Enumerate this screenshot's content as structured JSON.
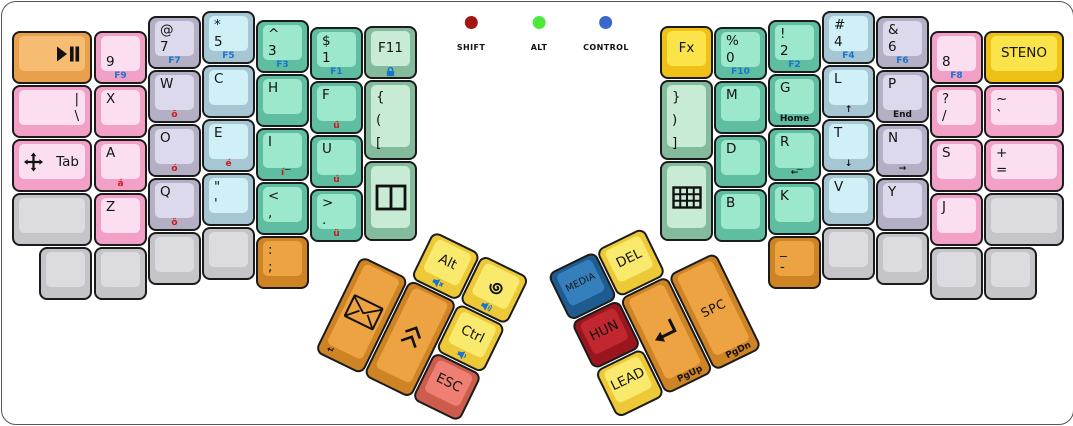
{
  "indicators": [
    {
      "name": "indicator-shift",
      "label": "SHIFT",
      "color": "#A21510",
      "x": 469
    },
    {
      "name": "indicator-alt",
      "label": "ALT",
      "color": "#4CE93B",
      "x": 537
    },
    {
      "name": "indicator-control",
      "label": "CONTROL",
      "color": "#3A67CE",
      "x": 604
    }
  ],
  "palette": {
    "pink": {
      "side": "#F2A0C5",
      "top": "#FBDFF1"
    },
    "lavender": {
      "side": "#B5AFC6",
      "top": "#DDD9EC"
    },
    "cyan": {
      "side": "#A6C6D4",
      "top": "#D0F0F8"
    },
    "green": {
      "side": "#5FBEA1",
      "top": "#9BE8CD"
    },
    "palegreen": {
      "side": "#84BB9D",
      "top": "#C8EBD6"
    },
    "gray": {
      "side": "#C4C4C9",
      "top": "#DCDCE0"
    },
    "orange": {
      "side": "#CE8424",
      "top": "#EDA341"
    },
    "orangelight": {
      "side": "#E9A04D",
      "top": "#F5BC72"
    },
    "yellow": {
      "side": "#EDC937",
      "top": "#F9E96C"
    },
    "yellowbright": {
      "side": "#EFC117",
      "top": "#FBE34A"
    },
    "red": {
      "side": "#CC5D4D",
      "top": "#EE7F72"
    },
    "darkred": {
      "side": "#99161F",
      "top": "#C2262F"
    },
    "blue": {
      "side": "#1E5C90",
      "top": "#3580BC"
    }
  },
  "legend_colors": {
    "blue": "#1874CE",
    "red": "#CE1A1A",
    "black": "#141414"
  },
  "keys": [
    {
      "name": "key-play-pause",
      "family": "orangelight",
      "x": 10,
      "y": 29,
      "w": 80,
      "icon": "play-pause",
      "iconAlign": "right"
    },
    {
      "name": "key-pipe-backslash",
      "family": "pink",
      "x": 10,
      "y": 83,
      "w": 80,
      "align": "right",
      "lines": [
        "|",
        "\\"
      ]
    },
    {
      "name": "key-tab",
      "family": "pink",
      "x": 10,
      "y": 137,
      "w": 80,
      "align": "right",
      "v": "c",
      "lines": [
        "Tab"
      ],
      "icon": "move",
      "iconAlign": "left"
    },
    {
      "name": "key-blank",
      "family": "gray",
      "x": 10,
      "y": 191,
      "w": 80
    },
    {
      "name": "key-blank",
      "family": "gray",
      "x": 37,
      "y": 245
    },
    {
      "name": "key-9",
      "family": "pink",
      "x": 92,
      "y": 29,
      "lines": [
        "",
        "9"
      ],
      "front": {
        "t": "F9",
        "c": "blue"
      }
    },
    {
      "name": "key-x",
      "family": "pink",
      "x": 92,
      "y": 83,
      "lines": [
        "X"
      ]
    },
    {
      "name": "key-a",
      "family": "pink",
      "x": 92,
      "y": 137,
      "lines": [
        "A"
      ],
      "front": {
        "t": "á",
        "c": "red"
      }
    },
    {
      "name": "key-z",
      "family": "pink",
      "x": 92,
      "y": 191,
      "lines": [
        "Z"
      ]
    },
    {
      "name": "key-blank",
      "family": "gray",
      "x": 92,
      "y": 245
    },
    {
      "name": "key-at-7",
      "family": "lavender",
      "x": 146,
      "y": 14,
      "lines": [
        "@",
        "7"
      ],
      "front": {
        "t": "F7",
        "c": "blue"
      }
    },
    {
      "name": "key-w",
      "family": "lavender",
      "x": 146,
      "y": 68,
      "lines": [
        "W"
      ],
      "front": {
        "t": "õ",
        "c": "red"
      }
    },
    {
      "name": "key-o",
      "family": "lavender",
      "x": 146,
      "y": 122,
      "lines": [
        "O"
      ],
      "front": {
        "t": "ó",
        "c": "red"
      }
    },
    {
      "name": "key-q",
      "family": "lavender",
      "x": 146,
      "y": 176,
      "lines": [
        "Q"
      ],
      "front": {
        "t": "ö",
        "c": "red"
      }
    },
    {
      "name": "key-blank",
      "family": "gray",
      "x": 146,
      "y": 230
    },
    {
      "name": "key-star-5",
      "family": "cyan",
      "x": 200,
      "y": 9,
      "lines": [
        "*",
        "5"
      ],
      "front": {
        "t": "F5",
        "c": "blue"
      }
    },
    {
      "name": "key-c",
      "family": "cyan",
      "x": 200,
      "y": 63,
      "lines": [
        "C"
      ]
    },
    {
      "name": "key-e",
      "family": "cyan",
      "x": 200,
      "y": 117,
      "lines": [
        "E"
      ],
      "front": {
        "t": "é",
        "c": "red"
      }
    },
    {
      "name": "key-quote",
      "family": "cyan",
      "x": 200,
      "y": 171,
      "lines": [
        "\"",
        "'"
      ]
    },
    {
      "name": "key-blank",
      "family": "gray",
      "x": 200,
      "y": 225
    },
    {
      "name": "key-caret-3",
      "family": "green",
      "x": 254,
      "y": 18,
      "lines": [
        "^",
        "3"
      ],
      "front": {
        "t": "F3",
        "c": "blue"
      }
    },
    {
      "name": "key-h",
      "family": "green",
      "x": 254,
      "y": 72,
      "lines": [
        "H"
      ]
    },
    {
      "name": "key-i",
      "family": "green",
      "x": 254,
      "y": 126,
      "lines": [
        "I"
      ],
      "sub": "_",
      "front": {
        "t": "í",
        "c": "red"
      }
    },
    {
      "name": "key-less-comma",
      "family": "green",
      "x": 254,
      "y": 180,
      "lines": [
        "<",
        ","
      ]
    },
    {
      "name": "key-colon-semicolon",
      "family": "orange",
      "x": 254,
      "y": 234,
      "lines": [
        ":",
        ";"
      ]
    },
    {
      "name": "key-dollar-1",
      "family": "green",
      "x": 308,
      "y": 25,
      "lines": [
        "$",
        "1"
      ],
      "front": {
        "t": "F1",
        "c": "blue"
      }
    },
    {
      "name": "key-f",
      "family": "green",
      "x": 308,
      "y": 79,
      "lines": [
        "F"
      ],
      "front": {
        "t": "ű",
        "c": "red"
      }
    },
    {
      "name": "key-u",
      "family": "green",
      "x": 308,
      "y": 133,
      "lines": [
        "U"
      ],
      "front": {
        "t": "ú",
        "c": "red"
      }
    },
    {
      "name": "key-greater-period",
      "family": "green",
      "x": 308,
      "y": 187,
      "lines": [
        ">",
        "."
      ],
      "front": {
        "t": "ü",
        "c": "red"
      }
    },
    {
      "name": "key-f11",
      "family": "palegreen",
      "x": 362,
      "y": 24,
      "center": true,
      "lines": [
        "F11"
      ],
      "front": {
        "icon": "lock"
      }
    },
    {
      "name": "key-open-brackets",
      "family": "palegreen",
      "x": 362,
      "y": 78,
      "h": 80,
      "lines": [
        "{",
        "(",
        "["
      ]
    },
    {
      "name": "key-window-split",
      "family": "palegreen",
      "x": 362,
      "y": 159,
      "h": 80,
      "center": true,
      "icon": "window-split"
    },
    {
      "name": "key-fx",
      "family": "yellowbright",
      "x": 658,
      "y": 24,
      "center": true,
      "lines": [
        "Fx"
      ]
    },
    {
      "name": "key-close-brackets",
      "family": "palegreen",
      "x": 658,
      "y": 78,
      "h": 80,
      "lines": [
        "}",
        ")",
        "]"
      ]
    },
    {
      "name": "key-keypad",
      "family": "palegreen",
      "x": 658,
      "y": 159,
      "h": 80,
      "center": true,
      "icon": "keypad-grid"
    },
    {
      "name": "key-percent-0",
      "family": "green",
      "x": 712,
      "y": 25,
      "lines": [
        "%",
        "0"
      ],
      "front": {
        "t": "F10",
        "c": "blue"
      }
    },
    {
      "name": "key-m",
      "family": "green",
      "x": 712,
      "y": 79,
      "lines": [
        "M"
      ]
    },
    {
      "name": "key-d",
      "family": "green",
      "x": 712,
      "y": 133,
      "lines": [
        "D"
      ]
    },
    {
      "name": "key-b",
      "family": "green",
      "x": 712,
      "y": 187,
      "lines": [
        "B"
      ]
    },
    {
      "name": "key-excl-2",
      "family": "green",
      "x": 766,
      "y": 18,
      "lines": [
        "!",
        "2"
      ],
      "front": {
        "t": "F2",
        "c": "blue"
      }
    },
    {
      "name": "key-g",
      "family": "green",
      "x": 766,
      "y": 72,
      "lines": [
        "G"
      ],
      "front": {
        "t": "Home",
        "c": "black"
      }
    },
    {
      "name": "key-r",
      "family": "green",
      "x": 766,
      "y": 126,
      "lines": [
        "R"
      ],
      "sub": "_",
      "front": {
        "t": "←",
        "c": "black"
      }
    },
    {
      "name": "key-k",
      "family": "green",
      "x": 766,
      "y": 180,
      "lines": [
        "K"
      ]
    },
    {
      "name": "key-underscore-dash",
      "family": "orange",
      "x": 766,
      "y": 234,
      "lines": [
        "_",
        "-"
      ]
    },
    {
      "name": "key-hash-4",
      "family": "cyan",
      "x": 820,
      "y": 9,
      "lines": [
        "#",
        "4"
      ],
      "front": {
        "t": "F4",
        "c": "blue"
      }
    },
    {
      "name": "key-l",
      "family": "cyan",
      "x": 820,
      "y": 63,
      "lines": [
        "L"
      ],
      "front": {
        "t": "↑",
        "c": "black"
      }
    },
    {
      "name": "key-t",
      "family": "cyan",
      "x": 820,
      "y": 117,
      "lines": [
        "T"
      ],
      "front": {
        "t": "↓",
        "c": "black"
      }
    },
    {
      "name": "key-v",
      "family": "cyan",
      "x": 820,
      "y": 171,
      "lines": [
        "V"
      ]
    },
    {
      "name": "key-blank",
      "family": "gray",
      "x": 820,
      "y": 225
    },
    {
      "name": "key-amp-6",
      "family": "lavender",
      "x": 874,
      "y": 14,
      "lines": [
        "&",
        "6"
      ],
      "front": {
        "t": "F6",
        "c": "blue"
      }
    },
    {
      "name": "key-p",
      "family": "lavender",
      "x": 874,
      "y": 68,
      "lines": [
        "P"
      ],
      "front": {
        "t": "End",
        "c": "black"
      }
    },
    {
      "name": "key-n",
      "family": "lavender",
      "x": 874,
      "y": 122,
      "lines": [
        "N"
      ],
      "front": {
        "t": "→",
        "c": "black"
      }
    },
    {
      "name": "key-y",
      "family": "lavender",
      "x": 874,
      "y": 176,
      "lines": [
        "Y"
      ]
    },
    {
      "name": "key-blank",
      "family": "gray",
      "x": 874,
      "y": 230
    },
    {
      "name": "key-8",
      "family": "pink",
      "x": 928,
      "y": 29,
      "lines": [
        "",
        "8"
      ],
      "front": {
        "t": "F8",
        "c": "blue"
      }
    },
    {
      "name": "key-question-slash",
      "family": "pink",
      "x": 928,
      "y": 83,
      "lines": [
        "?",
        "/"
      ]
    },
    {
      "name": "key-s",
      "family": "pink",
      "x": 928,
      "y": 137,
      "lines": [
        "S"
      ]
    },
    {
      "name": "key-j",
      "family": "pink",
      "x": 928,
      "y": 191,
      "lines": [
        "J"
      ]
    },
    {
      "name": "key-blank",
      "family": "gray",
      "x": 928,
      "y": 245
    },
    {
      "name": "key-steno",
      "family": "yellowbright",
      "x": 982,
      "y": 29,
      "w": 80,
      "center": true,
      "lines": [
        "STENO"
      ]
    },
    {
      "name": "key-tilde-backtick",
      "family": "pink",
      "x": 982,
      "y": 83,
      "w": 80,
      "lines": [
        "~",
        "`"
      ]
    },
    {
      "name": "key-plus-equals",
      "family": "pink",
      "x": 982,
      "y": 137,
      "w": 80,
      "lines": [
        "+",
        "="
      ]
    },
    {
      "name": "key-blank",
      "family": "gray",
      "x": 982,
      "y": 191,
      "w": 80
    },
    {
      "name": "key-blank",
      "family": "gray",
      "x": 982,
      "y": 245
    }
  ],
  "clusters": [
    {
      "name": "left-thumb-cluster",
      "x": 383,
      "y": 205,
      "angle": 26,
      "keys": [
        {
          "name": "key-alt",
          "family": "yellow",
          "x": 54,
          "y": 0,
          "center": true,
          "lines": [
            "Alt"
          ],
          "front": {
            "icon": "speaker-mute"
          }
        },
        {
          "name": "key-debian-spiral",
          "family": "yellow",
          "x": 108,
          "y": 0,
          "center": true,
          "icon": "spiral",
          "front": {
            "icon": "speaker-up"
          }
        },
        {
          "name": "key-mail",
          "family": "orange",
          "x": 0,
          "y": 54,
          "h": 107,
          "center": true,
          "icon": "envelope",
          "front": {
            "t": "↵",
            "c": "black",
            "align": "left"
          }
        },
        {
          "name": "key-chevrons-up",
          "family": "orange",
          "x": 54,
          "y": 54,
          "h": 107,
          "center": true,
          "icon": "chevron-double-up"
        },
        {
          "name": "key-ctrl",
          "family": "yellow",
          "x": 108,
          "y": 54,
          "center": true,
          "lines": [
            "Ctrl"
          ],
          "front": {
            "icon": "speaker-down"
          }
        },
        {
          "name": "key-esc",
          "family": "red",
          "x": 108,
          "y": 108,
          "center": true,
          "lines": [
            "ESC"
          ]
        }
      ]
    },
    {
      "name": "right-thumb-cluster",
      "x": 545,
      "y": 272,
      "angle": -26,
      "keys": [
        {
          "name": "key-media",
          "family": "blue",
          "x": 0,
          "y": 0,
          "center": true,
          "small": true,
          "lines": [
            "MEDIA"
          ]
        },
        {
          "name": "key-del",
          "family": "yellow",
          "x": 54,
          "y": 0,
          "center": true,
          "lines": [
            "DEL"
          ]
        },
        {
          "name": "key-hun",
          "family": "darkred",
          "x": 0,
          "y": 54,
          "center": true,
          "lines": [
            "HUN"
          ]
        },
        {
          "name": "key-enter",
          "family": "orange",
          "x": 54,
          "y": 54,
          "h": 107,
          "center": true,
          "icon": "return-arrow",
          "front": {
            "t": "PgUp",
            "c": "black",
            "align": "right"
          }
        },
        {
          "name": "key-space",
          "family": "orange",
          "x": 108,
          "y": 54,
          "h": 107,
          "center": true,
          "big": true,
          "lines": [
            "SPC"
          ],
          "front": {
            "t": "PgDn",
            "c": "black",
            "align": "right"
          }
        },
        {
          "name": "key-lead",
          "family": "yellow",
          "x": 0,
          "y": 108,
          "center": true,
          "lines": [
            "LEAD"
          ]
        }
      ]
    }
  ]
}
